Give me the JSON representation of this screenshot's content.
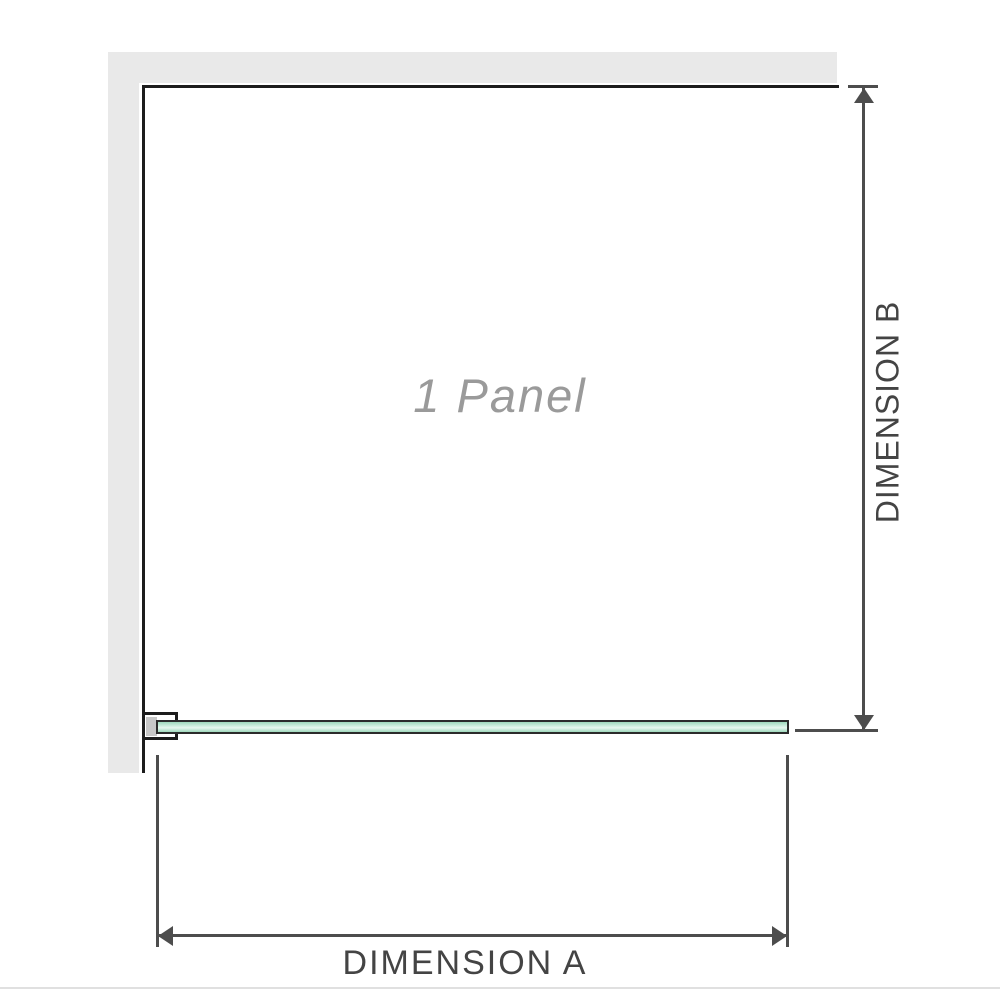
{
  "diagram": {
    "panel_label": "1 Panel",
    "dimension_a": {
      "label": "DIMENSION A"
    },
    "dimension_b": {
      "label": "DIMENSION B"
    }
  },
  "icons": {
    "dimension_b_top": "arrowhead-up-icon",
    "dimension_b_bottom": "arrowhead-down-icon",
    "dimension_a_left": "arrowhead-left-icon",
    "dimension_a_right": "arrowhead-right-icon"
  },
  "colors": {
    "wall_gray": "#e9e9e9",
    "outline_black": "#1c1c1c",
    "dimension_line": "#4d4d4d",
    "label_text": "#444444",
    "panel_text": "#9a9a9a",
    "glass_green": "#9ed8bc",
    "glass_green_mid": "#cdeedd",
    "glass_green_light": "#e7f7ee",
    "glass_outline": "#2b2b2b",
    "bracket_fill": "#c7c7c7",
    "separator": "#e0e0e0"
  }
}
